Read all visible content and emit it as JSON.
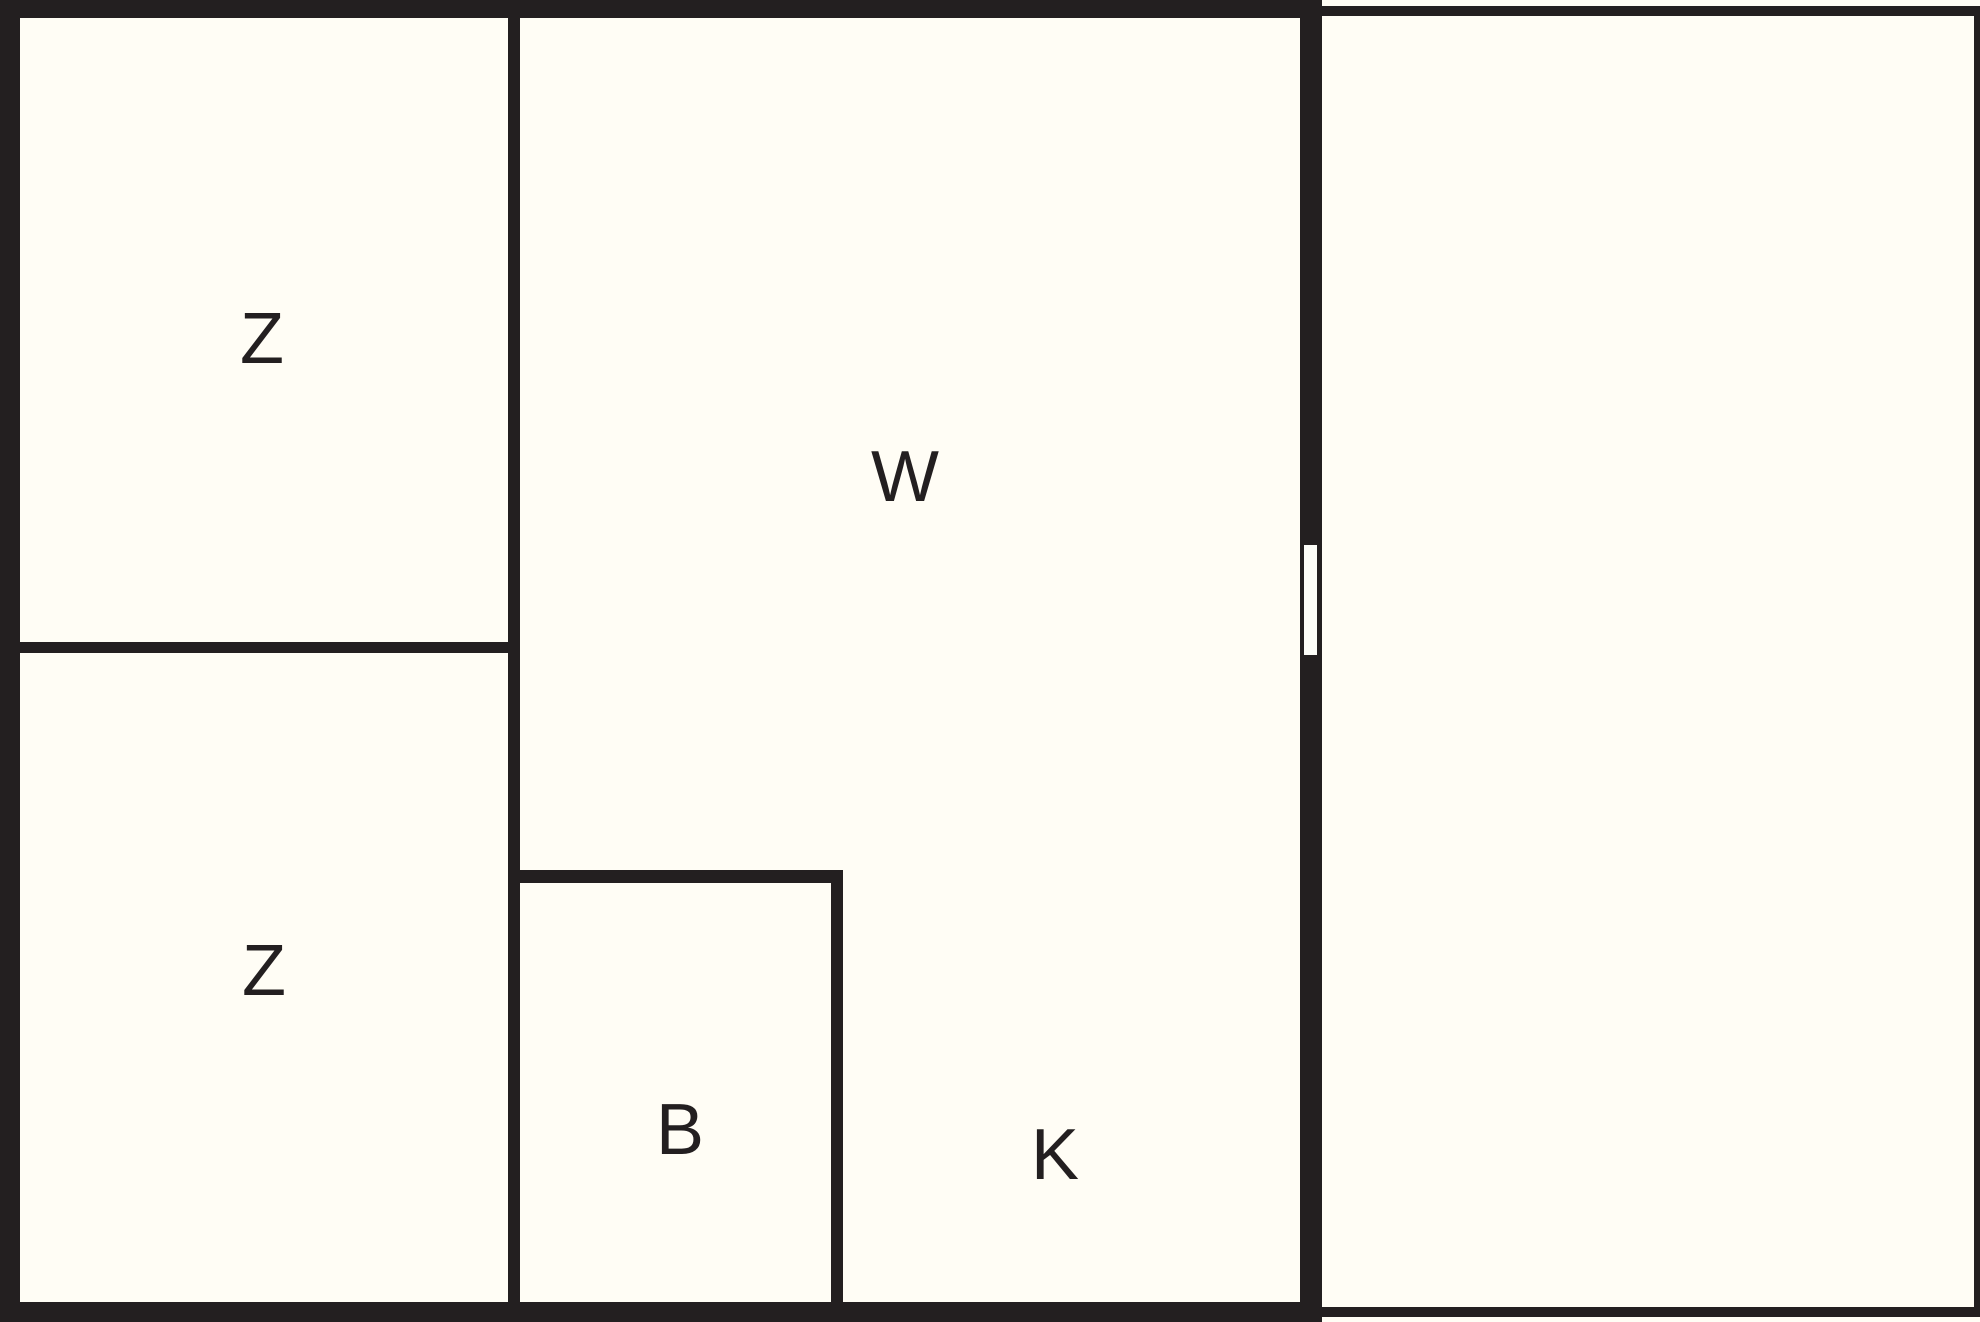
{
  "floor_plan": {
    "type": "floor-plan",
    "background_color": "#fffdf5",
    "wall_color": "#231f20",
    "door_color": "#fdfdf8",
    "labels": {
      "room_z_top": "Z",
      "room_z_bottom": "Z",
      "room_w": "W",
      "room_b": "B",
      "room_k": "K"
    }
  }
}
